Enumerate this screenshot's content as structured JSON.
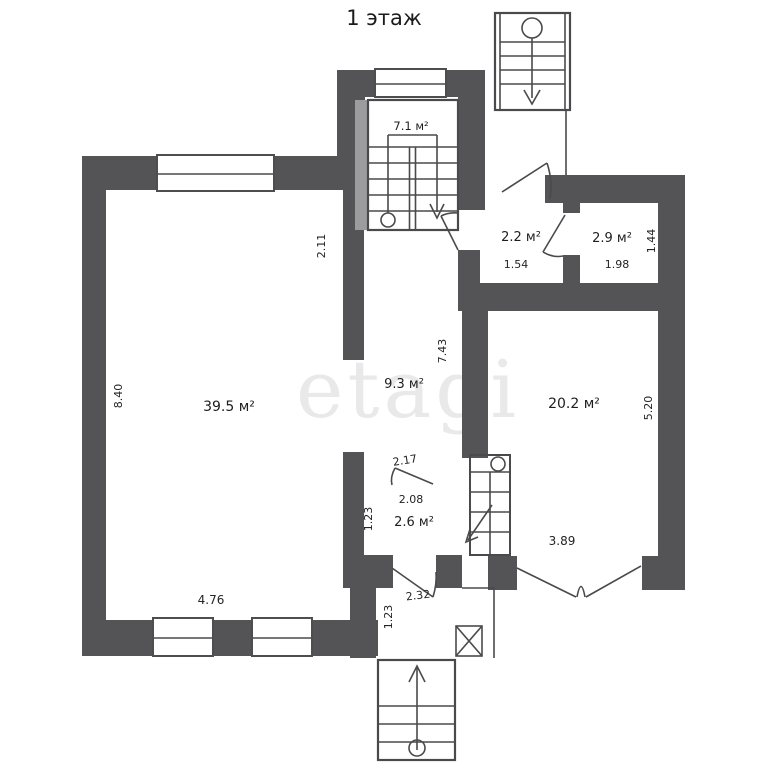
{
  "title": "1 этаж",
  "watermark": "etagi",
  "colors": {
    "wall": "#545456",
    "line": "#4a4a4c",
    "watermark": "#e9e9e9"
  },
  "rooms": {
    "stairwell": {
      "label": "7.1 м²"
    },
    "hall": {
      "label": "2.2 м²"
    },
    "wc": {
      "label": "2.9 м²"
    },
    "living": {
      "label": "39.5 м²"
    },
    "corridor": {
      "label": "9.3 м²"
    },
    "main": {
      "label": "20.2 м²"
    },
    "closet": {
      "label": "2.6 м²"
    }
  },
  "dims": {
    "living_top": "2.11",
    "living_height": "8.40",
    "living_width": "4.76",
    "hall_width": "1.54",
    "wc_width": "1.98",
    "wc_depth": "1.44",
    "corridor_height": "7.43",
    "main_height": "5.20",
    "main_width": "3.89",
    "closet_door": "2.17",
    "closet_width": "2.08",
    "closet_height": "1.23",
    "closet_bottom": "2.32",
    "lobby_height": "1.23"
  }
}
